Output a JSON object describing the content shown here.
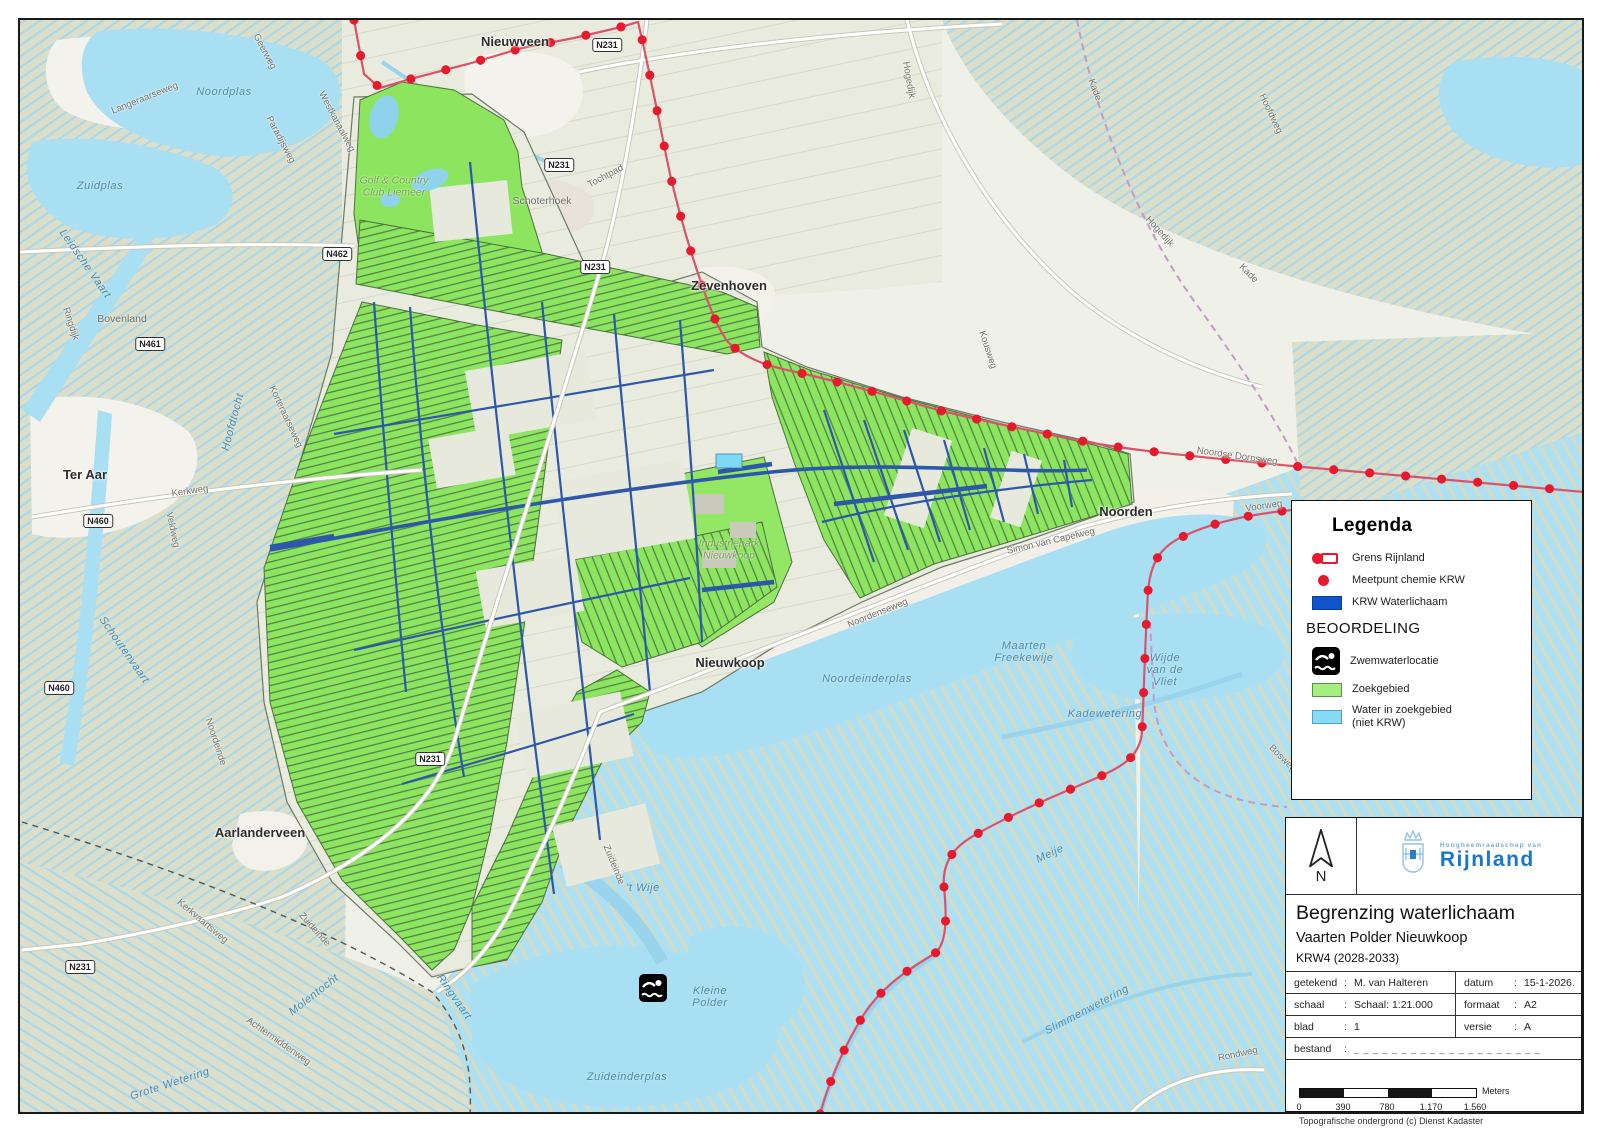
{
  "legend": {
    "title": "Legenda",
    "items": [
      {
        "icon": "grens-rijnland-icon",
        "label": "Grens Rijnland"
      },
      {
        "icon": "meetpunt-chemie-icon",
        "label": "Meetpunt chemie KRW"
      },
      {
        "icon": "krw-waterlichaam-swatch",
        "label": "KRW Waterlichaam"
      }
    ],
    "section_heading": "BEOORDELING",
    "beoordeling_items": [
      {
        "icon": "zwemwaterlocatie-icon",
        "label": "Zwemwaterlocatie"
      },
      {
        "icon": "zoekgebied-swatch",
        "label": "Zoekgebied"
      },
      {
        "icon": "water-in-zoekgebied-swatch",
        "label": "Water in zoekgebied\n(niet KRW)"
      }
    ]
  },
  "title_block": {
    "north_label": "N",
    "org_small": "Hoogheemraadschap van",
    "org_name": "Rijnland",
    "title": "Begrenzing waterlichaam",
    "subtitle": "Vaarten Polder Nieuwkoop",
    "period": "KRW4 (2028-2033)",
    "fields": {
      "getekend_label": "getekend",
      "getekend_value": "M. van Halteren",
      "datum_label": "datum",
      "datum_value": "15-1-2026.",
      "schaal_label": "schaal",
      "schaal_value": "Schaal: 1:21.000",
      "formaat_label": "formaat",
      "formaat_value": "A2",
      "blad_label": "blad",
      "blad_value": "1",
      "versie_label": "versie",
      "versie_value": "A",
      "bestand_label": "bestand",
      "bestand_value": "_ _ _ _ _ _ _ _ _ _ _ _ _ _ _ _ _ _ _ _",
      "colon": ":"
    },
    "scalebar": {
      "ticks": [
        "0",
        "390",
        "780",
        "1.170",
        "1.560"
      ],
      "unit": "Meters"
    },
    "attribution": "Topografische ondergrond (c) Dienst Kadaster"
  },
  "map": {
    "colors": {
      "zoekgebied_green": "#8DE55F",
      "krw_blue": "#2D58AA",
      "water_blue": "#A9DFF3",
      "grens_red": "#E8192C",
      "water_niet_krw": "#7FD9F4"
    },
    "labels": [
      {
        "t": "Nieuwveen",
        "x": 513,
        "y": 40,
        "r": 0,
        "c": "town"
      },
      {
        "t": "Zevenhoven",
        "x": 727,
        "y": 284,
        "r": 0,
        "c": "town"
      },
      {
        "t": "Noorden",
        "x": 1124,
        "y": 510,
        "r": 0,
        "c": "town"
      },
      {
        "t": "Nieuwkoop",
        "x": 728,
        "y": 661,
        "r": 0,
        "c": "town"
      },
      {
        "t": "Ter Aar",
        "x": 83,
        "y": 473,
        "r": 0,
        "c": "town"
      },
      {
        "t": "Aarlanderveen",
        "x": 258,
        "y": 831,
        "r": 0,
        "c": "town"
      },
      {
        "t": "Schoterhoek",
        "x": 540,
        "y": 200,
        "r": 0,
        "c": "townsm"
      },
      {
        "t": "Bovenland",
        "x": 120,
        "y": 318,
        "r": 0,
        "c": "townsm"
      },
      {
        "t": "Noordplas",
        "x": 222,
        "y": 90,
        "r": 0,
        "c": "water"
      },
      {
        "t": "Zuidplas",
        "x": 98,
        "y": 184,
        "r": 0,
        "c": "water"
      },
      {
        "t": "Leidsche Vaart",
        "x": 83,
        "y": 262,
        "r": 55,
        "c": "water"
      },
      {
        "t": "Noordeinderplas",
        "x": 865,
        "y": 677,
        "r": 0,
        "c": "water"
      },
      {
        "t": "Zuideinderplas",
        "x": 625,
        "y": 1075,
        "r": 0,
        "c": "water"
      },
      {
        "t": "'t Wije",
        "x": 641,
        "y": 886,
        "r": 0,
        "c": "water"
      },
      {
        "t": "Kleine\nPolder",
        "x": 708,
        "y": 995,
        "r": 0,
        "c": "water"
      },
      {
        "t": "Wijde\nvan de\nVliet",
        "x": 1163,
        "y": 668,
        "r": 0,
        "c": "water"
      },
      {
        "t": "Maarten\nFreekewije",
        "x": 1022,
        "y": 650,
        "r": 0,
        "c": "water"
      },
      {
        "t": "Kadewetering",
        "x": 1103,
        "y": 712,
        "r": 0,
        "c": "water"
      },
      {
        "t": "Slimmenwetering",
        "x": 1085,
        "y": 1008,
        "r": -28,
        "c": "water"
      },
      {
        "t": "Grote Wetering",
        "x": 168,
        "y": 1082,
        "r": -18,
        "c": "water"
      },
      {
        "t": "Molentocht",
        "x": 312,
        "y": 993,
        "r": -38,
        "c": "water"
      },
      {
        "t": "Hoofdtocht",
        "x": 231,
        "y": 420,
        "r": -75,
        "c": "water"
      },
      {
        "t": "Schoutenvaart",
        "x": 122,
        "y": 648,
        "r": 55,
        "c": "water"
      },
      {
        "t": "Ringvaart",
        "x": 452,
        "y": 995,
        "r": 55,
        "c": "water"
      },
      {
        "t": "Meije",
        "x": 1048,
        "y": 852,
        "r": -25,
        "c": "water"
      },
      {
        "t": "Geerweg",
        "x": 262,
        "y": 50,
        "r": 62,
        "c": "street"
      },
      {
        "t": "Langeraarseweg",
        "x": 143,
        "y": 97,
        "r": -22,
        "c": "street"
      },
      {
        "t": "Paradijsweg",
        "x": 278,
        "y": 138,
        "r": 62,
        "c": "street"
      },
      {
        "t": "Westkanaalweg",
        "x": 334,
        "y": 120,
        "r": 62,
        "c": "street"
      },
      {
        "t": "Ringdijk",
        "x": 68,
        "y": 322,
        "r": 72,
        "c": "street"
      },
      {
        "t": "Kerkweg",
        "x": 188,
        "y": 490,
        "r": -8,
        "c": "street"
      },
      {
        "t": "Veldweg",
        "x": 170,
        "y": 528,
        "r": 78,
        "c": "street"
      },
      {
        "t": "Korteraarseweg",
        "x": 283,
        "y": 415,
        "r": 65,
        "c": "street"
      },
      {
        "t": "Kerkvaartsweg",
        "x": 200,
        "y": 920,
        "r": 40,
        "c": "street"
      },
      {
        "t": "Achtermiddenweg",
        "x": 276,
        "y": 1040,
        "r": 35,
        "c": "street"
      },
      {
        "t": "Zuideinde",
        "x": 312,
        "y": 928,
        "r": 48,
        "c": "street"
      },
      {
        "t": "Zuideinde",
        "x": 611,
        "y": 863,
        "r": 68,
        "c": "street"
      },
      {
        "t": "Noordeinde",
        "x": 213,
        "y": 740,
        "r": 72,
        "c": "street"
      },
      {
        "t": "Noordenseweg",
        "x": 876,
        "y": 612,
        "r": -22,
        "c": "street"
      },
      {
        "t": "Simon van Capelweg",
        "x": 1049,
        "y": 540,
        "r": -13,
        "c": "street"
      },
      {
        "t": "Voorweg",
        "x": 1262,
        "y": 505,
        "r": -8,
        "c": "street"
      },
      {
        "t": "Noordse Dorpsweg",
        "x": 1235,
        "y": 455,
        "r": 8,
        "c": "street"
      },
      {
        "t": "Tochtpad",
        "x": 604,
        "y": 175,
        "r": -28,
        "c": "street"
      },
      {
        "t": "Hogedijk",
        "x": 906,
        "y": 78,
        "r": 80,
        "c": "street"
      },
      {
        "t": "Hogedijk",
        "x": 1157,
        "y": 230,
        "r": 48,
        "c": "street"
      },
      {
        "t": "Kade",
        "x": 1092,
        "y": 88,
        "r": 70,
        "c": "street"
      },
      {
        "t": "Kade",
        "x": 1246,
        "y": 272,
        "r": 45,
        "c": "street"
      },
      {
        "t": "Hoofdweg",
        "x": 1268,
        "y": 112,
        "r": 65,
        "c": "street"
      },
      {
        "t": "Kousweg",
        "x": 985,
        "y": 348,
        "r": 72,
        "c": "street"
      },
      {
        "t": "Bosweg",
        "x": 1280,
        "y": 757,
        "r": 45,
        "c": "street"
      },
      {
        "t": "Rondweg",
        "x": 1236,
        "y": 1053,
        "r": -12,
        "c": "street"
      },
      {
        "t": "Golf & Country\nClub Liemeer",
        "x": 392,
        "y": 185,
        "r": 0,
        "c": "area"
      },
      {
        "t": "Industriepark\nNieuwkoop",
        "x": 727,
        "y": 548,
        "r": 0,
        "c": "area"
      }
    ],
    "road_shields": [
      {
        "t": "N231",
        "x": 605,
        "y": 43
      },
      {
        "t": "N231",
        "x": 557,
        "y": 163
      },
      {
        "t": "N462",
        "x": 335,
        "y": 252
      },
      {
        "t": "N231",
        "x": 593,
        "y": 265
      },
      {
        "t": "N461",
        "x": 148,
        "y": 342
      },
      {
        "t": "N460",
        "x": 96,
        "y": 519
      },
      {
        "t": "N460",
        "x": 57,
        "y": 686
      },
      {
        "t": "N231",
        "x": 428,
        "y": 757
      },
      {
        "t": "N231",
        "x": 78,
        "y": 965
      }
    ]
  }
}
